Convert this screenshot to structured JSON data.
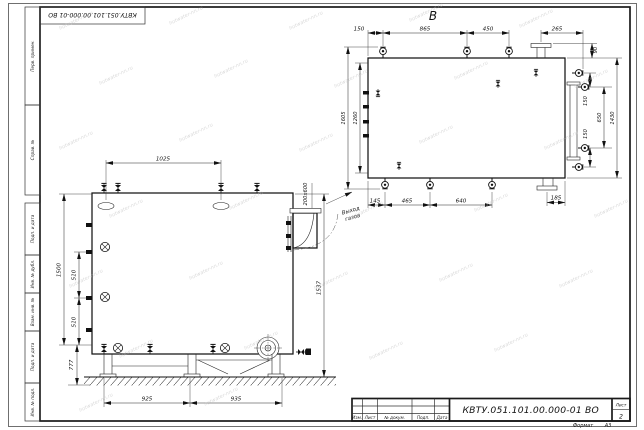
{
  "titleblock": {
    "designation": "КВТУ.051.101.00.000-01 ВО",
    "columns": [
      "Изм.",
      "Лист",
      "№ докум.",
      "Подп.",
      "Дата"
    ],
    "sheet_label": "Лист",
    "sheet_number": "2",
    "format_label": "Формат",
    "format_value": "А3"
  },
  "margin": {
    "perv": "Перв. примен.",
    "sprav": "Справ. №",
    "podp1": "Подп. и дата",
    "dubl": "Инв. № дубл.",
    "vzam": "Взам. инв. №",
    "podp2": "Подп. и дата",
    "podl": "Инв. № подл."
  },
  "front_view": {
    "dim_top": "1025",
    "dim_left_total": "1500",
    "dim_left_seg1": "510",
    "dim_left_seg2": "510",
    "dim_left_bottom": "777",
    "dim_right": "1537",
    "dim_bottom_left": "925",
    "dim_bottom_right": "935",
    "duct_label": "200x600",
    "note_line1": "Выход",
    "note_line2": "газов"
  },
  "top_view": {
    "label": "В",
    "dim_top_1": "150",
    "dim_top_2": "865",
    "dim_top_3": "450",
    "dim_top_4": "265",
    "dim_right_small": "90",
    "dim_right_seg1": "150",
    "dim_right_mid": "650",
    "dim_right_seg2": "150",
    "dim_right_total": "1430",
    "dim_left_outer": "1605",
    "dim_left_inner": "1260",
    "dim_bottom_1": "145",
    "dim_bottom_2": "465",
    "dim_bottom_3": "640",
    "dim_bottom_4": "185"
  },
  "watermark": {
    "text": "hotwater-nn.ru"
  }
}
